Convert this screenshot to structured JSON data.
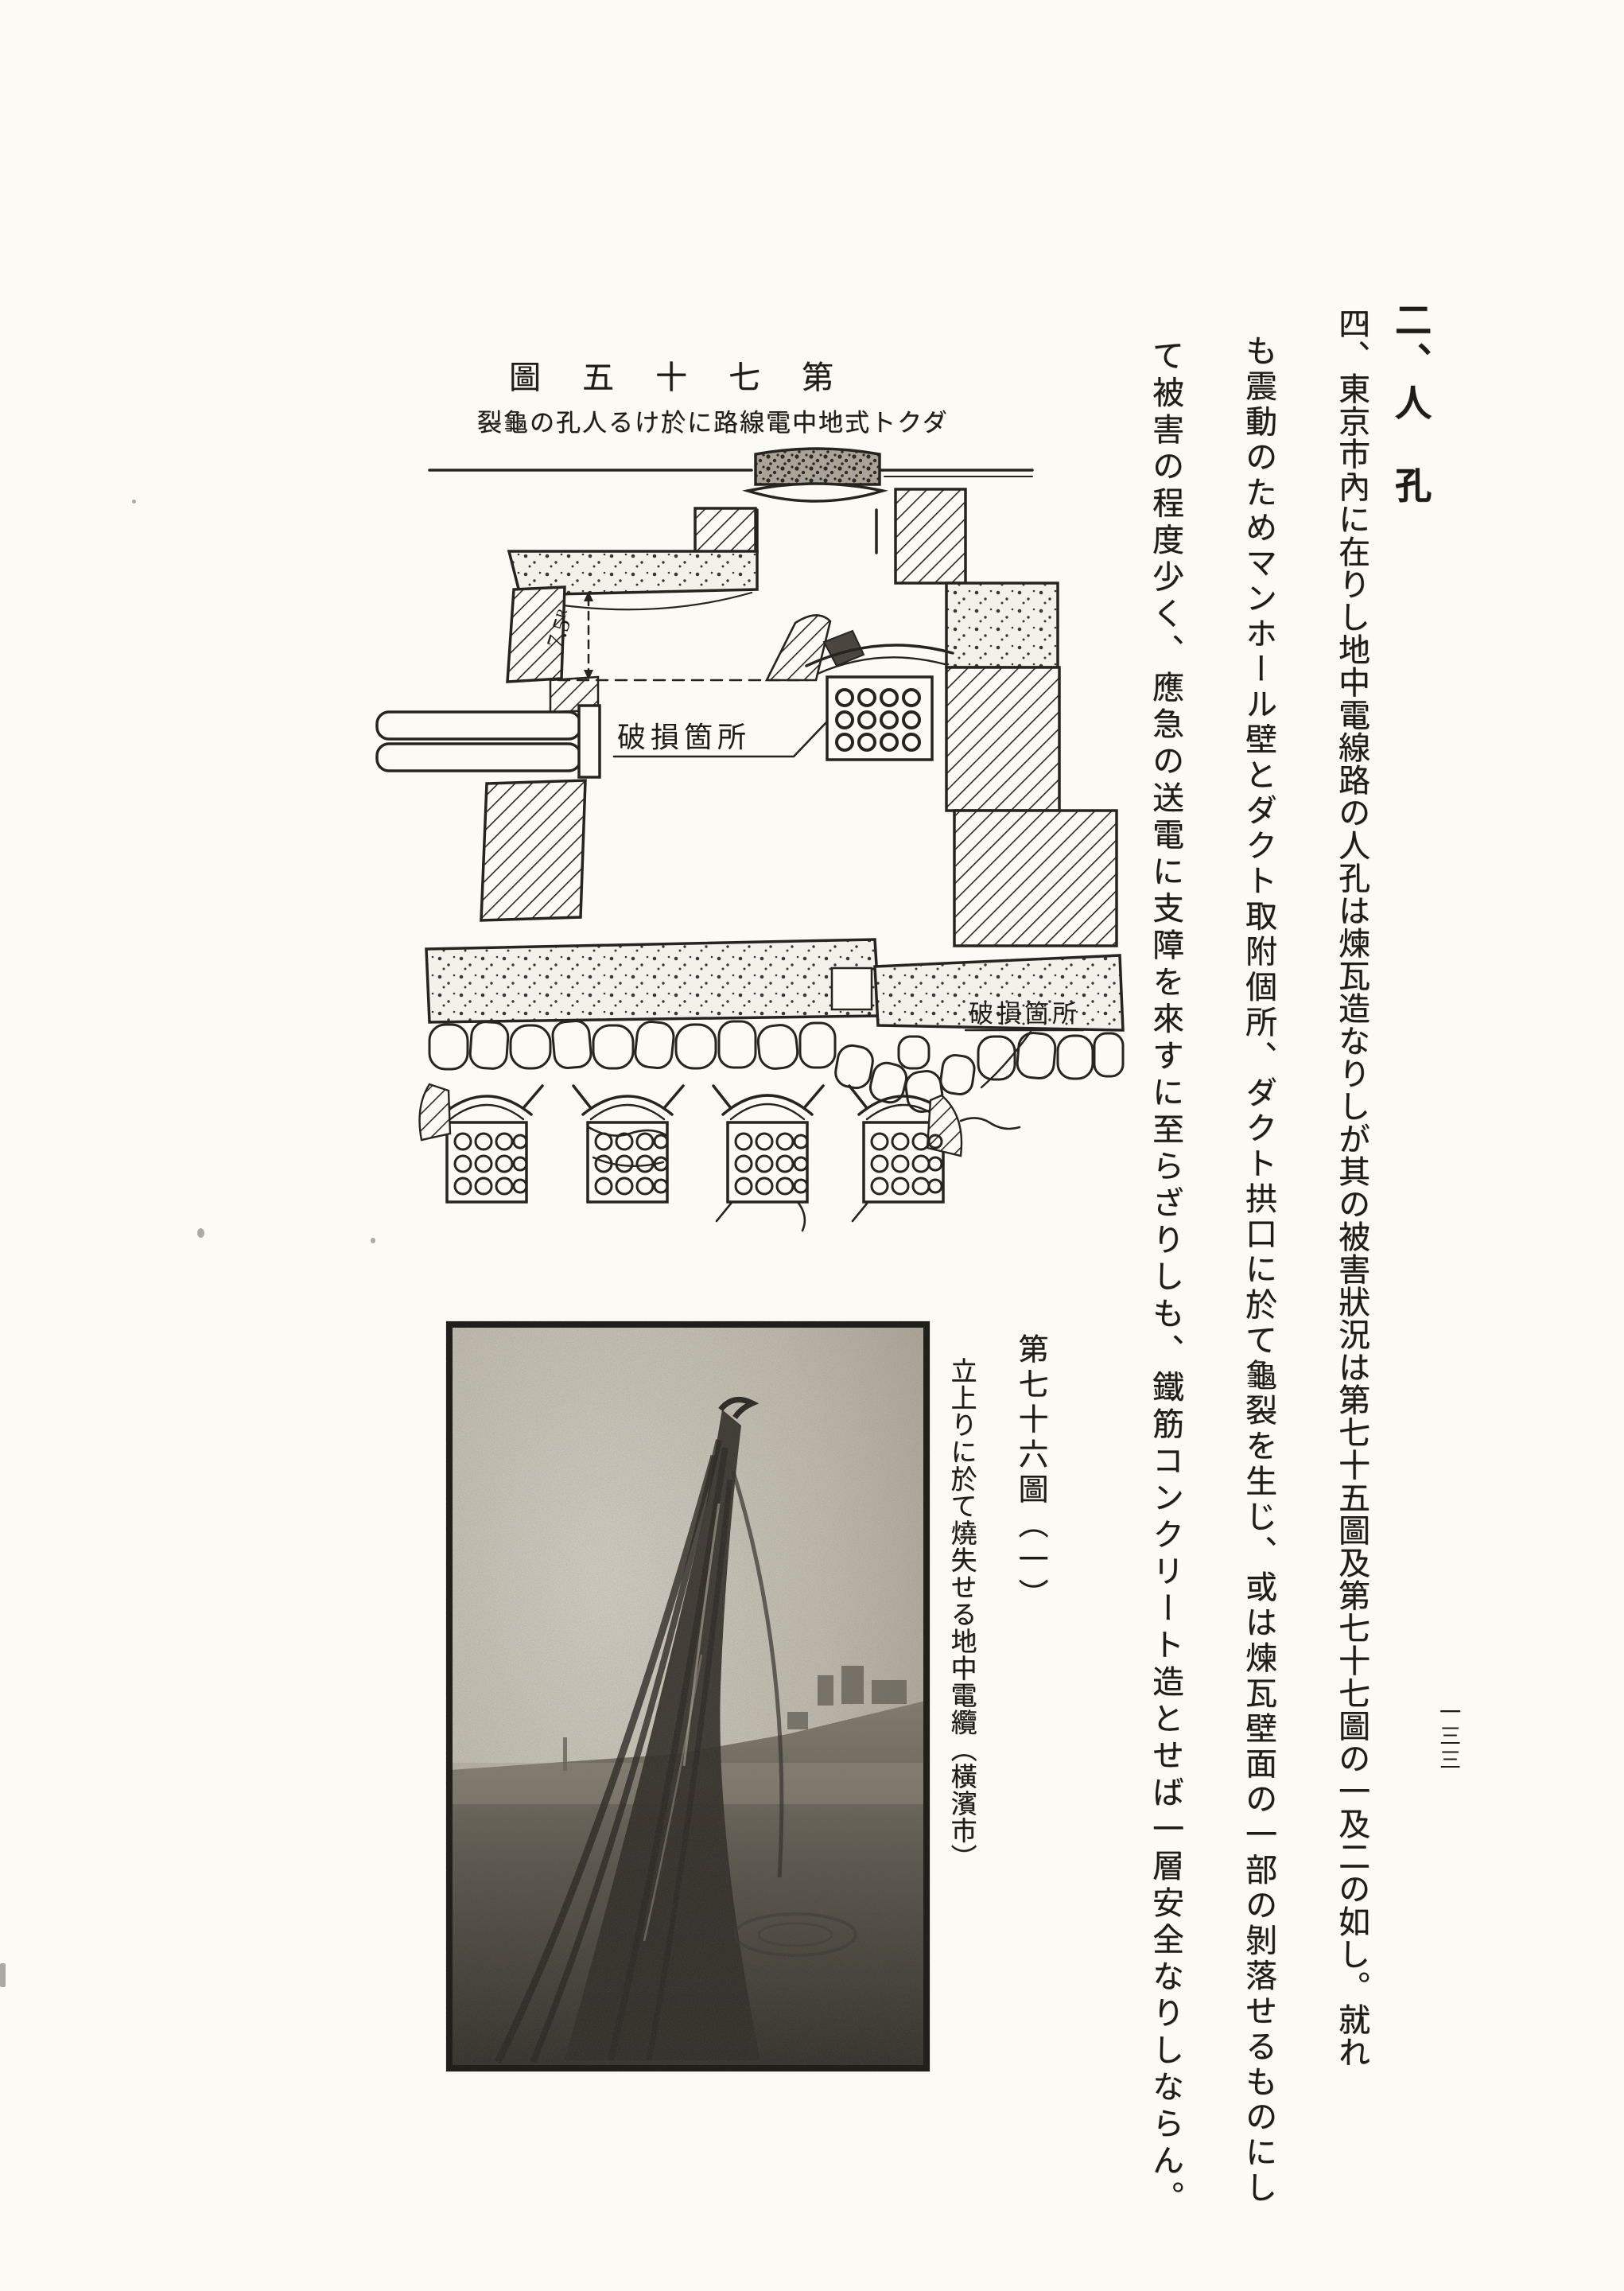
{
  "text": {
    "section_header": "二、人　孔",
    "page_number": "一三三",
    "body_columns": [
      "四、東京市內に在りし地中電線路の人孔は煉瓦造なりしが其の被害狀況は第七十五圖及第七十七圖の一及二の如し。就れ",
      "も震動のためマンホール壁とダクト取附個所、ダクト拱口に於て龜裂を生じ、或は煉瓦壁面の一部の剝落せるものにし",
      "て被害の程度少く、應急の送電に支障を來すに至らざりしも、鐵筋コンクリート造とせば一層安全なりしならん。"
    ]
  },
  "figure_75": {
    "title": "第七十五圖",
    "caption": "ダクト式地中電線路に於ける人孔の龜裂",
    "labels": {
      "damage_upper": "破損箇所",
      "damage_lower": "破損箇所",
      "dimension": "7.5ᴿ"
    }
  },
  "figure_76": {
    "title": "第七十六圖（一）",
    "caption": "立上りに於て燒失せる地中電纜（橫濱市）"
  }
}
